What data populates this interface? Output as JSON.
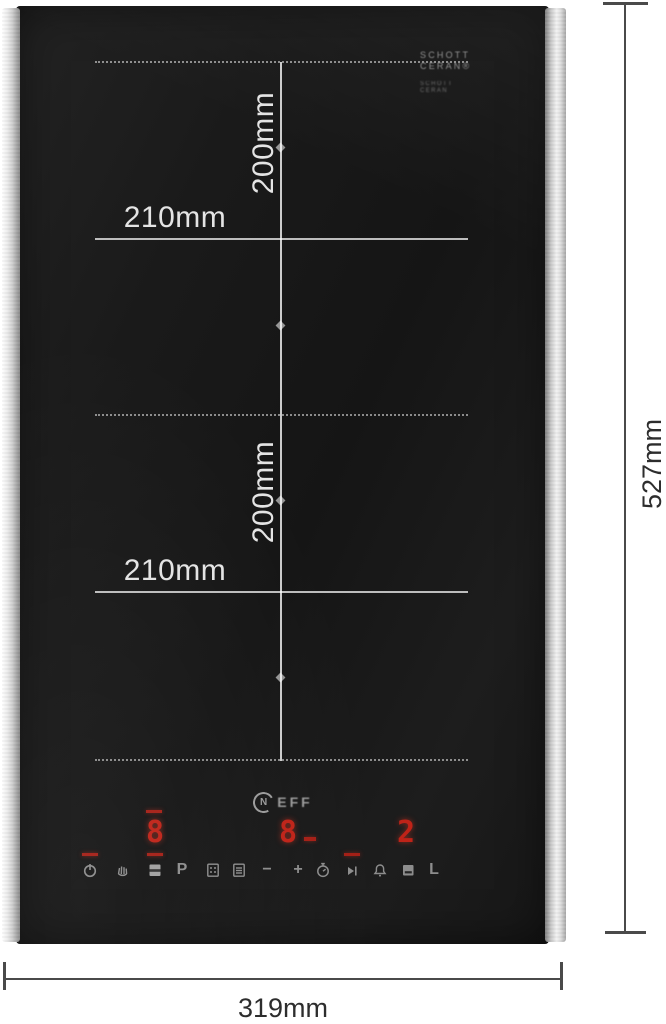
{
  "product": {
    "brand_logo_n": "N",
    "brand_logo_rest": "EFF",
    "glass_print": {
      "line1": "SCHOTT",
      "line2": "CERAN®",
      "small_line1": "SCHOTT",
      "small_line2": "CERAN"
    },
    "zones": [
      {
        "depth": "200mm",
        "width": "210mm"
      },
      {
        "depth": "200mm",
        "width": "210mm"
      }
    ],
    "display": {
      "left": "8",
      "middle": "8",
      "right": "2"
    },
    "controls": {
      "powerboost": "P",
      "minus": "−",
      "plus": "+",
      "lock": "L",
      "icon_names": [
        "power-icon",
        "wipe-hand-icon",
        "zone-select-icon",
        "powerboost-label",
        "sensor-pad-icon",
        "program-pad-icon",
        "minus-label",
        "plus-label",
        "timer-icon",
        "skip-bar-icon",
        "bell-icon",
        "display-pad-icon",
        "lock-label"
      ]
    }
  },
  "dimensions": {
    "overall_height": "527mm",
    "overall_width": "319mm"
  },
  "colors": {
    "display_red": "#c2241a",
    "glass_black": "#1a1a1a",
    "marking_white": "#e0e0e0",
    "dim_line_gray": "#4a4a4a",
    "icon_gray": "#8d8d8d",
    "steel_light": "#e8e8e8"
  }
}
